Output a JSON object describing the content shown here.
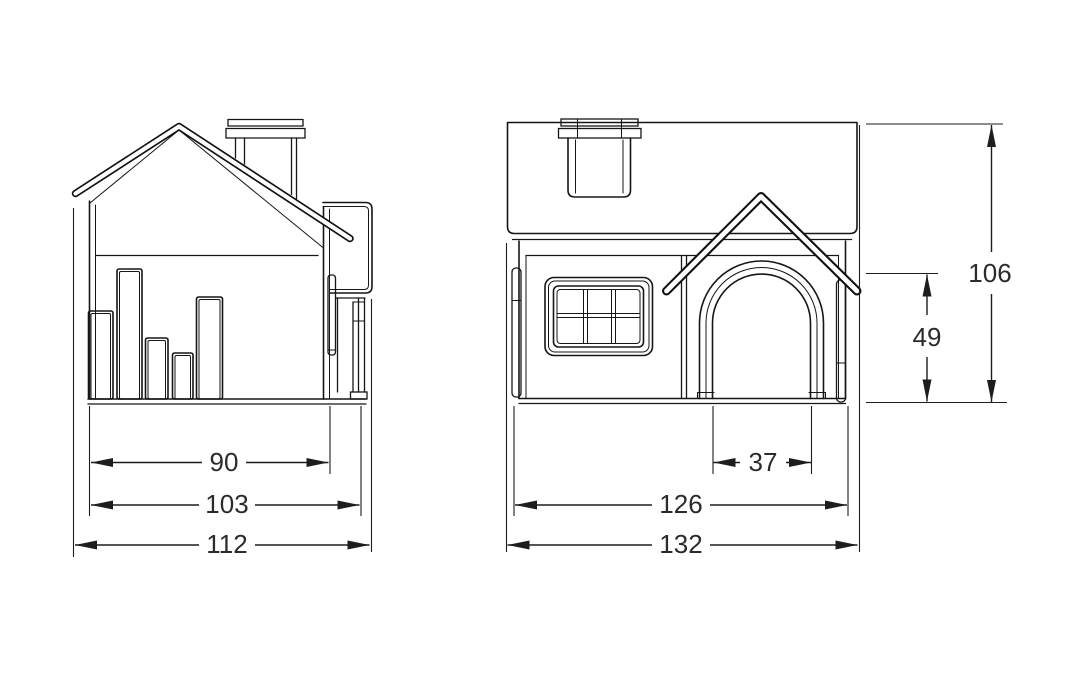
{
  "drawing": {
    "type": "technical-dimensioned-drawing",
    "subject": "pet-house-two-views",
    "background_color": "#ffffff",
    "line_color": "#161616",
    "dimension_text_color": "#2b2b2b",
    "views": {
      "side": {
        "parts": [
          "gable-roof",
          "chimney",
          "wall-slats",
          "door-canopy-profile",
          "arch-leg-profile",
          "base"
        ]
      },
      "front": {
        "parts": [
          "roof-slab",
          "chimney",
          "six-pane-window",
          "door-gable-canopy",
          "arched-door-opening",
          "base"
        ]
      }
    }
  },
  "dims": {
    "side": {
      "inner": "90",
      "mid": "103",
      "full": "112"
    },
    "front": {
      "door_width": "37",
      "inner": "126",
      "full": "132",
      "height": "106",
      "door_height": "49"
    }
  }
}
